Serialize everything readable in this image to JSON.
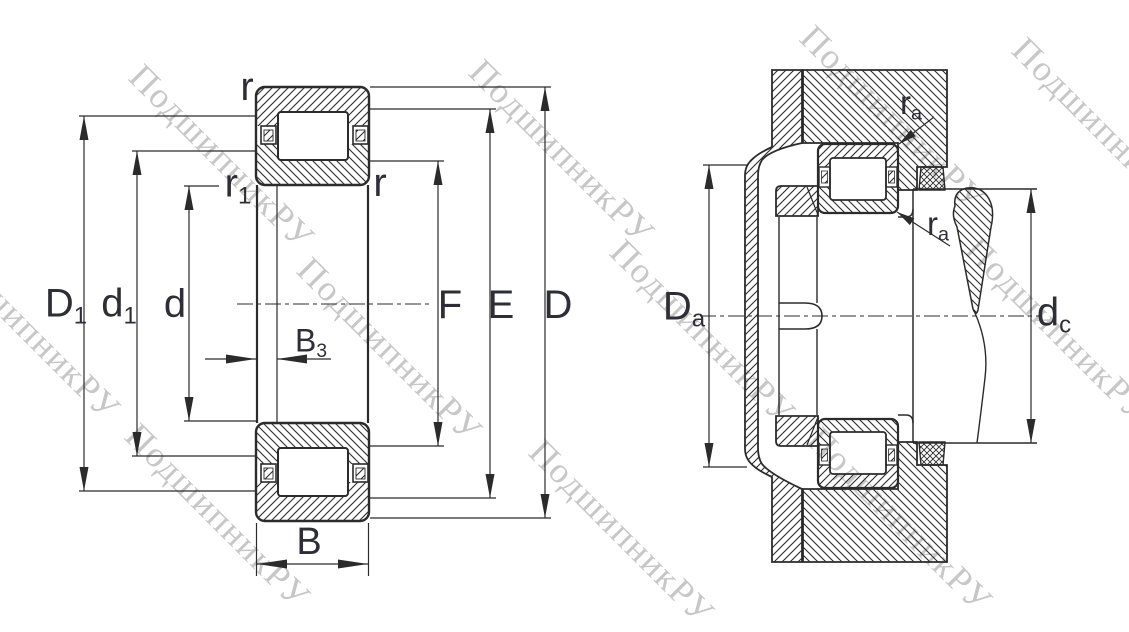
{
  "watermark": {
    "text": "ПодшипникРУ",
    "color": "#c7c7c7"
  },
  "colors": {
    "background": "#ffffff",
    "line": "#2b2b2b",
    "label": "#2e2f36",
    "watermark": "#c7c7c7"
  },
  "views": {
    "left": {
      "name": "bearing cross-section with boundary dimensions"
    },
    "right": {
      "name": "mounting example with abutment dimensions"
    }
  },
  "labels": {
    "r_top": {
      "main": "r",
      "sub": ""
    },
    "r1": {
      "main": "r",
      "sub": "1"
    },
    "r_right": {
      "main": "r",
      "sub": ""
    },
    "D1": {
      "main": "D",
      "sub": "1"
    },
    "d1": {
      "main": "d",
      "sub": "1"
    },
    "d": {
      "main": "d",
      "sub": ""
    },
    "B3": {
      "main": "B",
      "sub": "3"
    },
    "B": {
      "main": "B",
      "sub": ""
    },
    "F": {
      "main": "F",
      "sub": ""
    },
    "E": {
      "main": "E",
      "sub": ""
    },
    "D": {
      "main": "D",
      "sub": ""
    },
    "Da": {
      "main": "D",
      "sub": "a"
    },
    "dc": {
      "main": "d",
      "sub": "c"
    },
    "ra_top": {
      "main": "r",
      "sub": "a"
    },
    "ra_bottom": {
      "main": "r",
      "sub": "a"
    }
  }
}
